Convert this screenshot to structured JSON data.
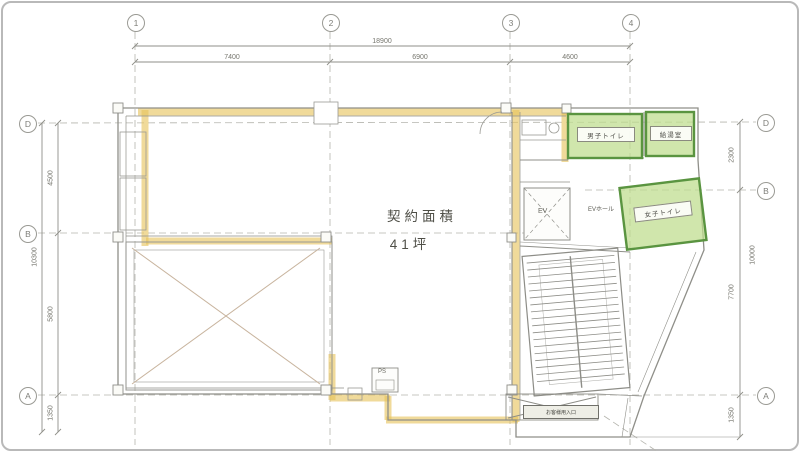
{
  "colors": {
    "highlight_yellow": "#E8C35C",
    "highlight_green": "#BEDC8C",
    "green_border": "#5A9440",
    "line_gray": "#8F8F89"
  },
  "grid": {
    "cols": [
      "1",
      "2",
      "3",
      "4"
    ],
    "rows_left": [
      "D",
      "B",
      "A"
    ],
    "rows_right": [
      "D",
      "B",
      "A"
    ]
  },
  "dims": {
    "top": {
      "total": "18900",
      "segments": [
        "7400",
        "6900",
        "4600"
      ]
    },
    "left": {
      "total": "10300",
      "segments": [
        "4500",
        "5800"
      ],
      "below": "1350"
    },
    "right": {
      "total": "10000",
      "segments": [
        "2300",
        "7700"
      ],
      "below": "1350"
    }
  },
  "area": {
    "line1": "契約面積",
    "line2": "41坪"
  },
  "rooms": {
    "mens_toilet": "男子トイレ",
    "kitchenette": "給湯室",
    "womens_toilet": "女子トイレ",
    "ev_hall": "EVホール",
    "elevator": "EV",
    "pipe_shaft": "PS",
    "entrance_note": "お客様用入口"
  }
}
